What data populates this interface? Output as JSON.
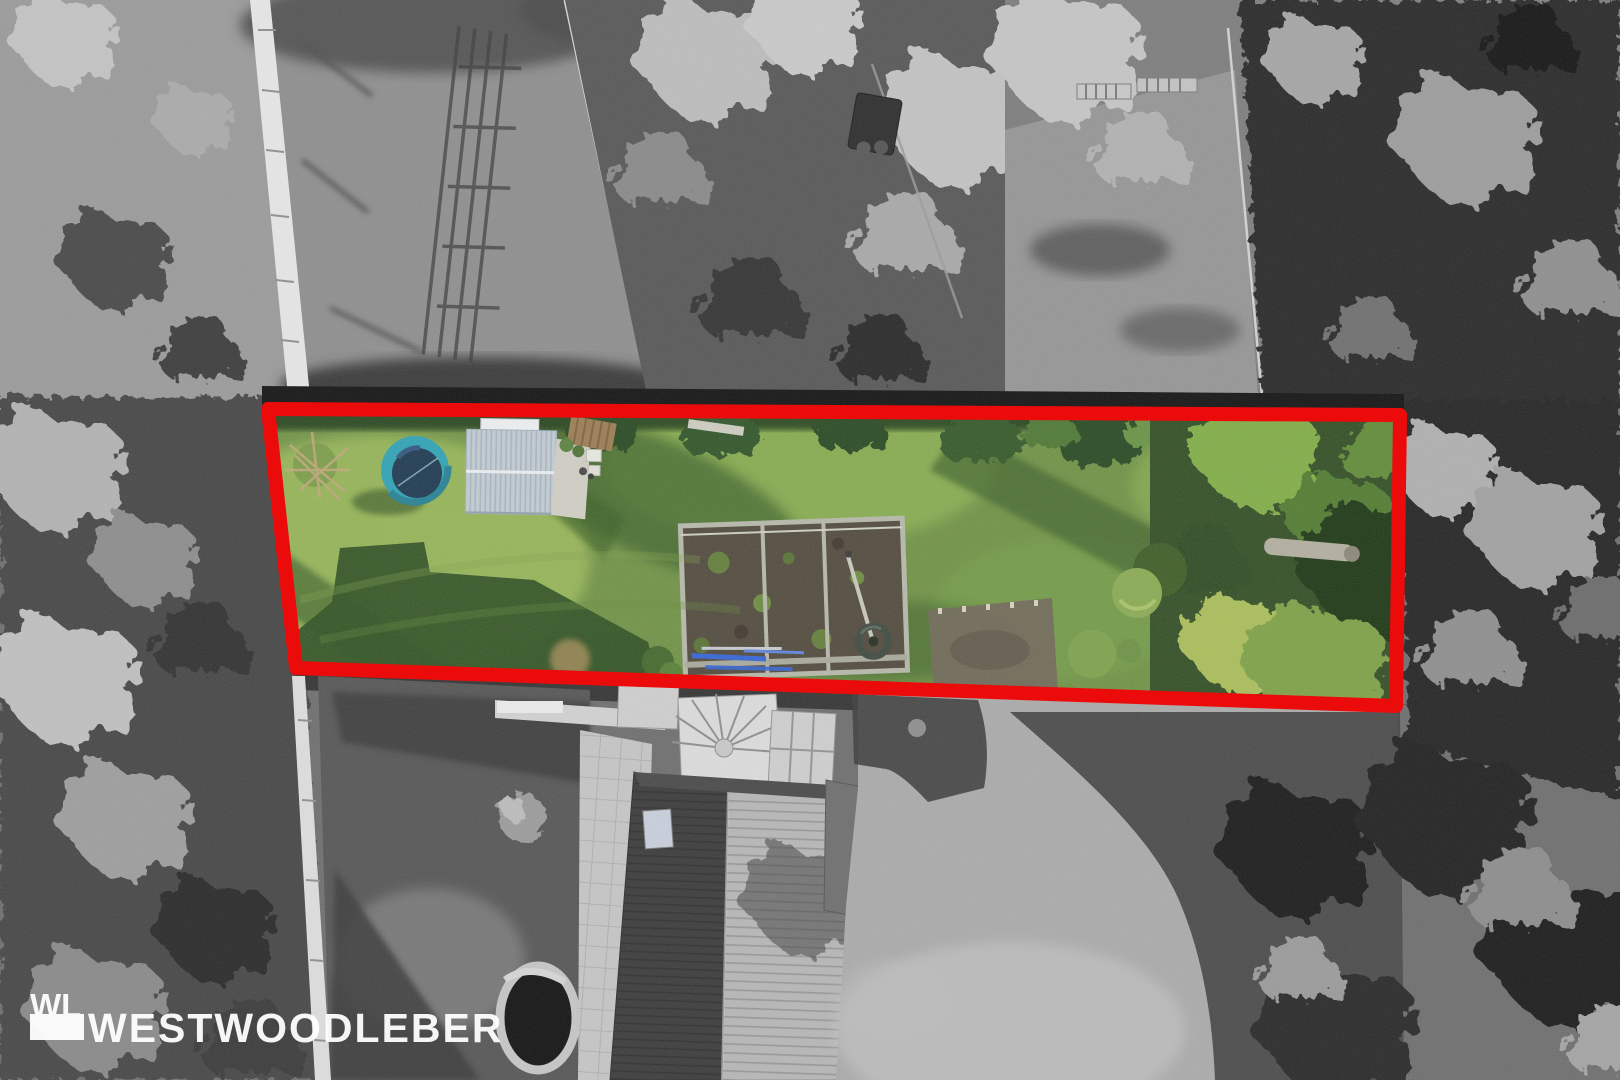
{
  "watermark": {
    "brand": "WESTWOODLEBER",
    "monogram": "WL",
    "color": "#ffffff"
  },
  "plot_highlight": {
    "outline_color": "#ec0b0b",
    "outline_width": "14",
    "style": "colour-pop plot boundary over grayscale aerial photo"
  },
  "palette": {
    "lawn_sunlit": "#93b24f",
    "lawn_mid": "#6d9140",
    "lawn_shadow": "#3a6128",
    "deep_shadow": "#2a4e1c",
    "trampoline_ring": "#2aa3b5",
    "trampoline_mat": "#17344d",
    "shed_roof": "#c4ced6",
    "greenhouse_soil": "#4d4537",
    "pipe_blue": "#2f62d8",
    "hedge_dark": "#23441a"
  }
}
